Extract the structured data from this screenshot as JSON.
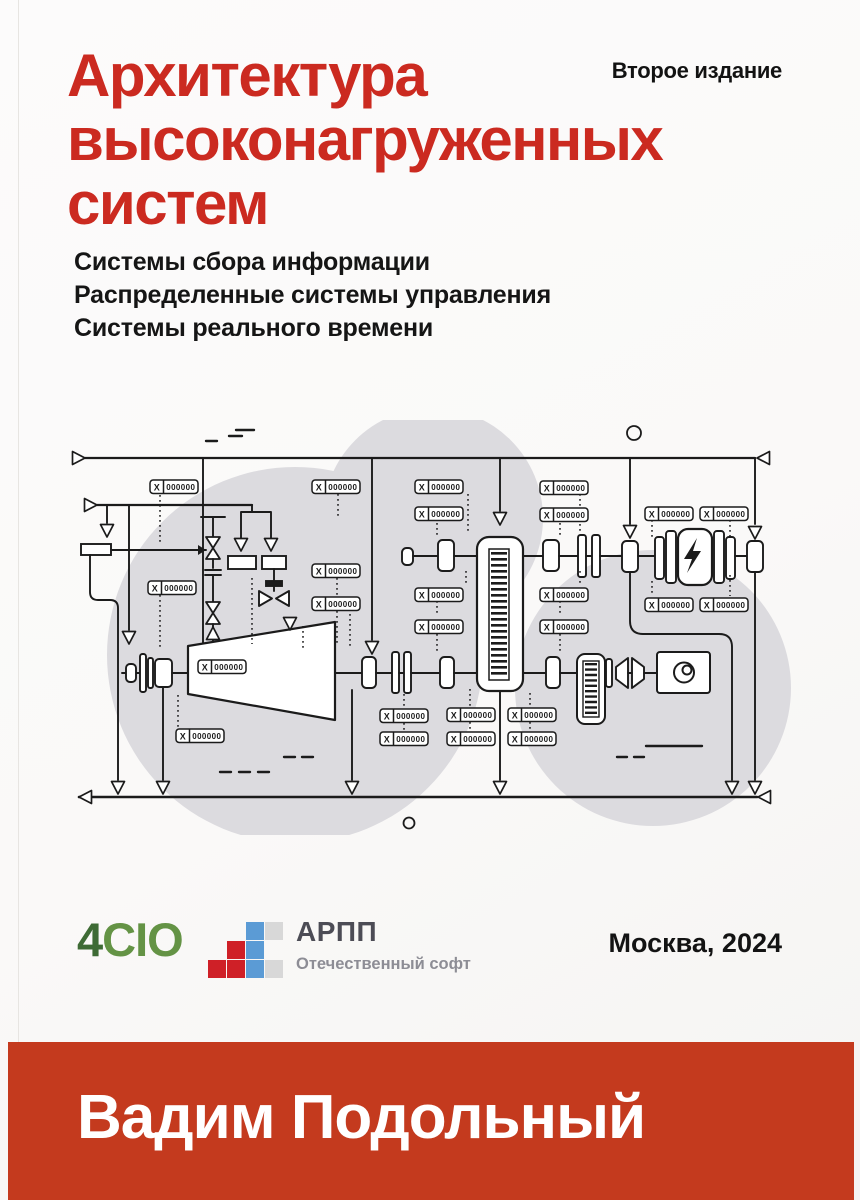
{
  "edition_label": "Второе издание",
  "title": "Архитектура\nвысоконагруженных\nсистем",
  "topics": "Системы сбора информации\nРаспределенные системы управления\nСистемы реального времени",
  "imprint": {
    "city_year": "Москва, 2024"
  },
  "author": "Вадим Подольный",
  "logos": {
    "four_cio": {
      "digit": "4",
      "letters": "CIO"
    },
    "arpp": {
      "name": "АРПП",
      "tagline": "Отечественный софт"
    }
  },
  "diagram": {
    "tag": {
      "x": "X",
      "value": "000000"
    }
  },
  "colors": {
    "title_red": "#cb2a20",
    "band_red": "#c43a1e",
    "cio_green_dark": "#3e6b35",
    "cio_green": "#649345",
    "arpp_blue": "#5b9bd5",
    "arpp_red": "#cf2027",
    "arpp_gray": "#d8d8d8",
    "blob_gray": "#dcdbdf",
    "ink": "#1b1b1b"
  }
}
